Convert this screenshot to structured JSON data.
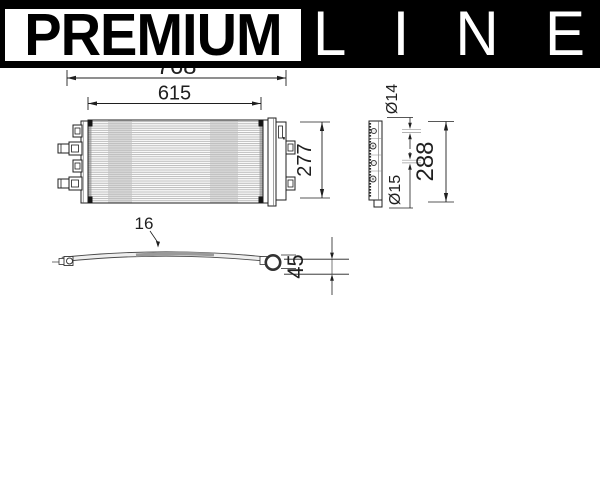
{
  "drawing": {
    "type": "technical-drawing-condenser",
    "front_view": {
      "dim_total_width": "768",
      "dim_core_width": "615",
      "dim_height": "277"
    },
    "side_view": {
      "dim_port_top_diameter": "Ø14",
      "dim_port_bottom_diameter": "Ø15",
      "dim_height": "288"
    },
    "top_view": {
      "dim_thickness": "16",
      "dim_bow_depth": "45"
    },
    "colors": {
      "line": "#1f1f1f",
      "fins": "#a8a8a8",
      "shade_band": "#c0c0c0"
    }
  },
  "banner": {
    "premium": "PREMIUM",
    "line_letters": [
      "L",
      "I",
      "N",
      "E"
    ],
    "colors": {
      "bar_bg": "#000000",
      "premium_bg": "#ffffff",
      "premium_text": "#000000",
      "line_text": "#ffffff"
    }
  }
}
